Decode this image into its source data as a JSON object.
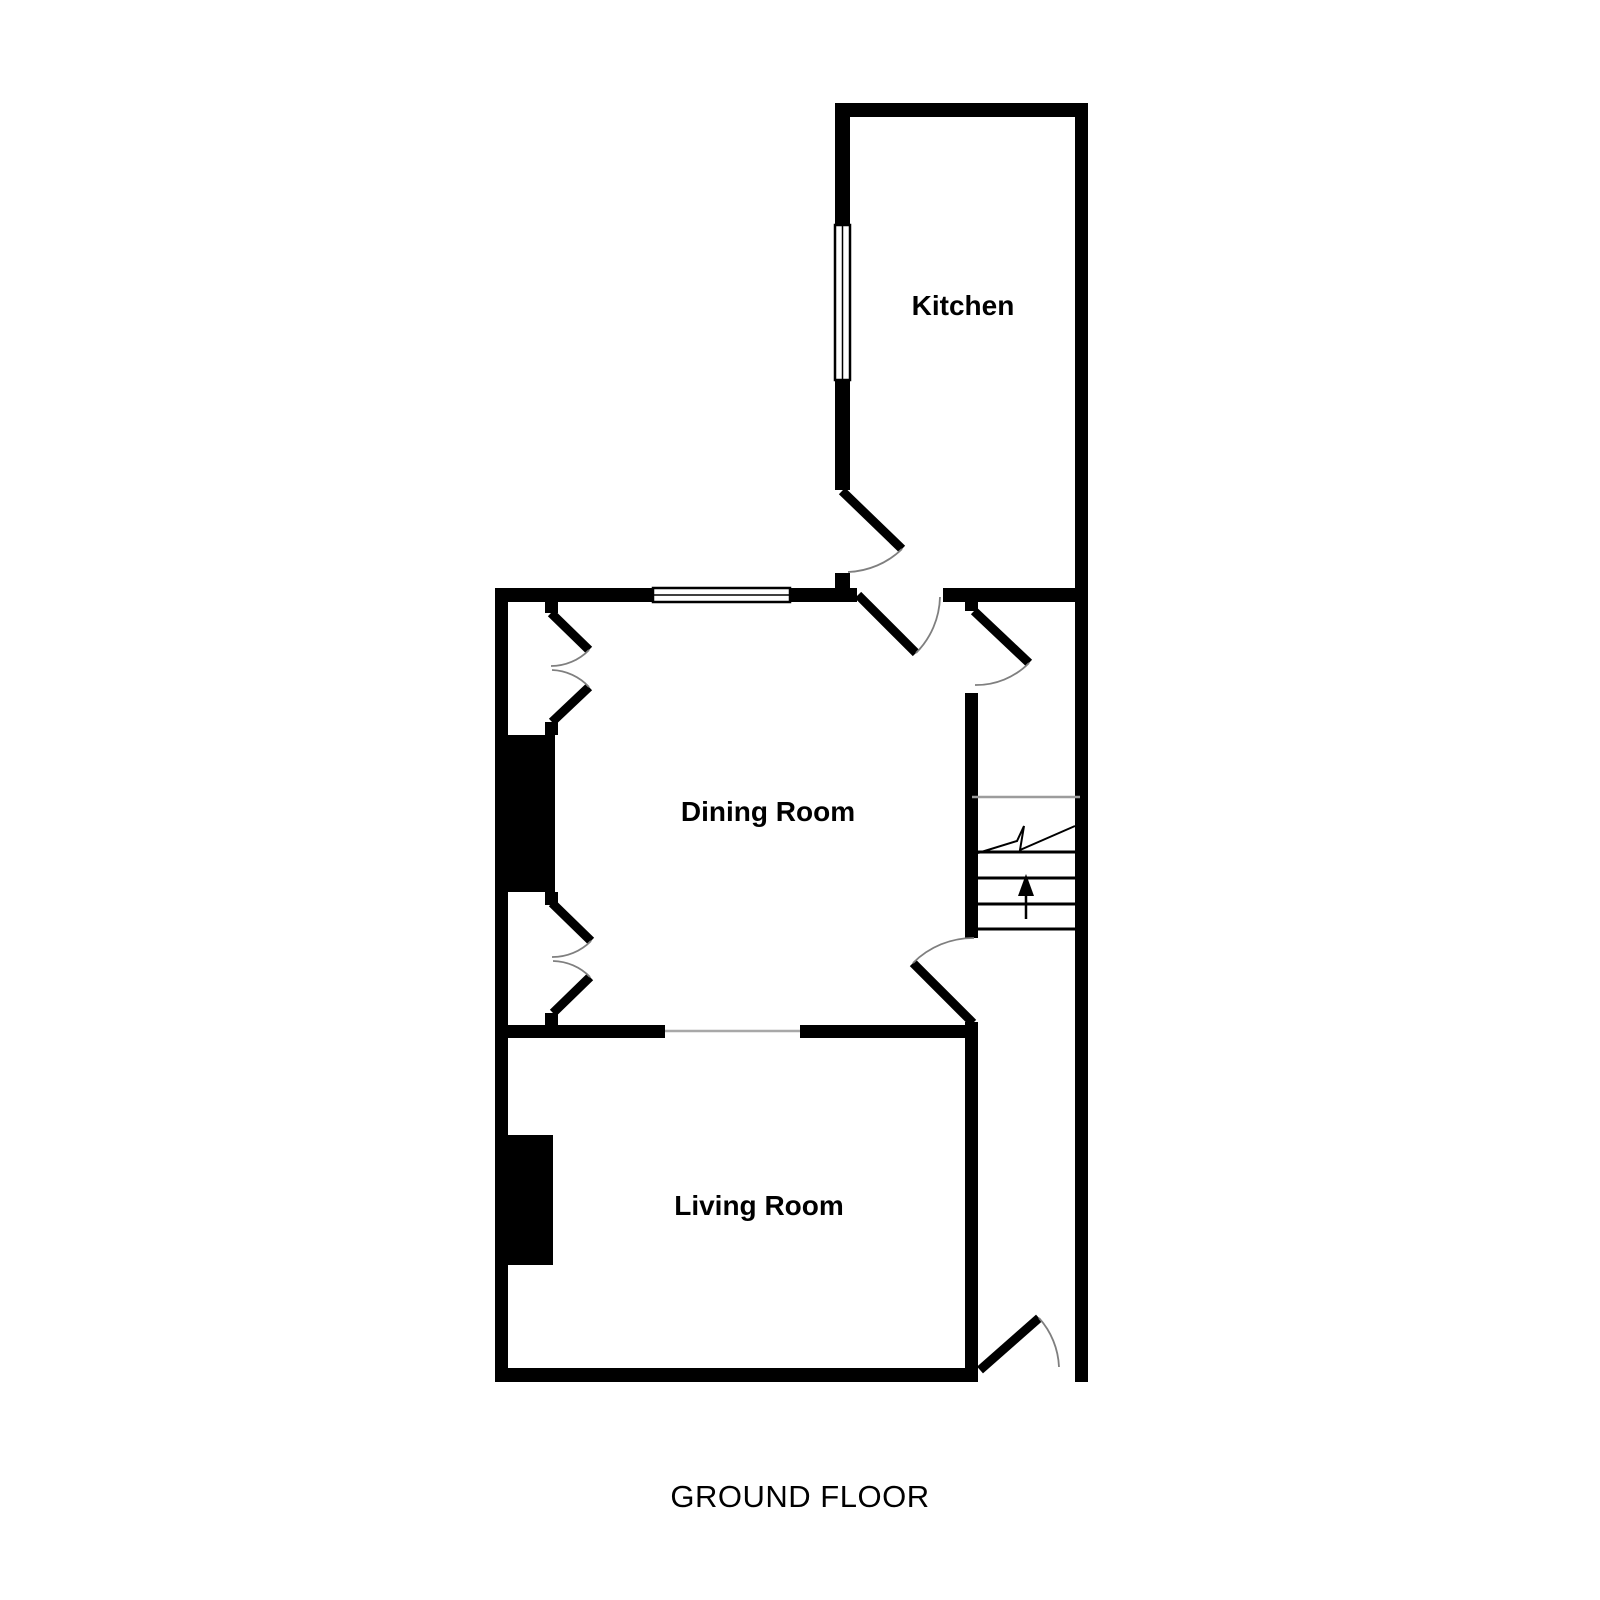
{
  "plan": {
    "title": "GROUND FLOOR",
    "rooms": {
      "kitchen": {
        "label": "Kitchen"
      },
      "dining": {
        "label": "Dining Room"
      },
      "living": {
        "label": "Living Room"
      }
    },
    "stairs": {
      "direction": "up"
    },
    "colors": {
      "wall": "#000000",
      "background": "#ffffff",
      "door_swing": "#7f7f7f",
      "stair_landing_line": "#9c9c9c",
      "open_plan_line": "#a8a8a8"
    }
  }
}
